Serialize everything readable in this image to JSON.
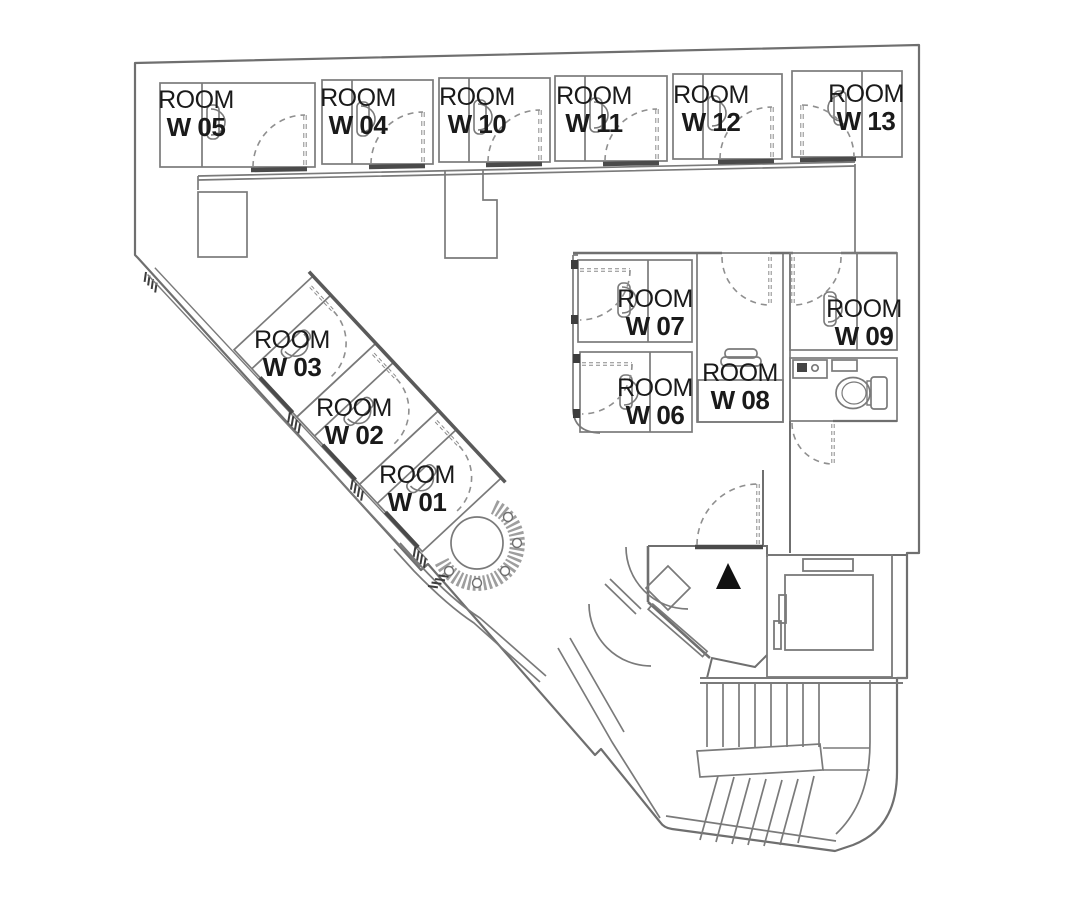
{
  "title": "Floor plan - W rooms",
  "colors": {
    "background": "#ffffff",
    "wall": "#777777",
    "wall_dark": "#585858",
    "sill": "#4a4a4a",
    "dashed": "#8a8a8a",
    "text": "#1a1a1a",
    "entrance_marker": "#111111"
  },
  "rooms": [
    {
      "id": "w05",
      "line1": "ROOM",
      "line2": "W 05"
    },
    {
      "id": "w04",
      "line1": "ROOM",
      "line2": "W 04"
    },
    {
      "id": "w10",
      "line1": "ROOM",
      "line2": "W 10"
    },
    {
      "id": "w11",
      "line1": "ROOM",
      "line2": "W 11"
    },
    {
      "id": "w12",
      "line1": "ROOM",
      "line2": "W 12"
    },
    {
      "id": "w13",
      "line1": "ROOM",
      "line2": "W 13"
    },
    {
      "id": "w03",
      "line1": "ROOM",
      "line2": "W 03"
    },
    {
      "id": "w02",
      "line1": "ROOM",
      "line2": "W 02"
    },
    {
      "id": "w01",
      "line1": "ROOM",
      "line2": "W 01"
    },
    {
      "id": "w07",
      "line1": "ROOM",
      "line2": "W 07"
    },
    {
      "id": "w06",
      "line1": "ROOM",
      "line2": "W 06"
    },
    {
      "id": "w08",
      "line1": "ROOM",
      "line2": "W 08"
    },
    {
      "id": "w09",
      "line1": "ROOM",
      "line2": "W 09"
    }
  ],
  "icons": {
    "entrance_marker": "entrance-triangle-icon",
    "toilet": "toilet-icon",
    "washbasin": "washbasin-icon",
    "shelf": "shelf-icon",
    "elevator": "elevator-icon",
    "stairs": "stairs-icon",
    "planter": "spiral-planter-icon",
    "basin": "room-basin-icon",
    "door_swing": "door-swing-icon"
  }
}
